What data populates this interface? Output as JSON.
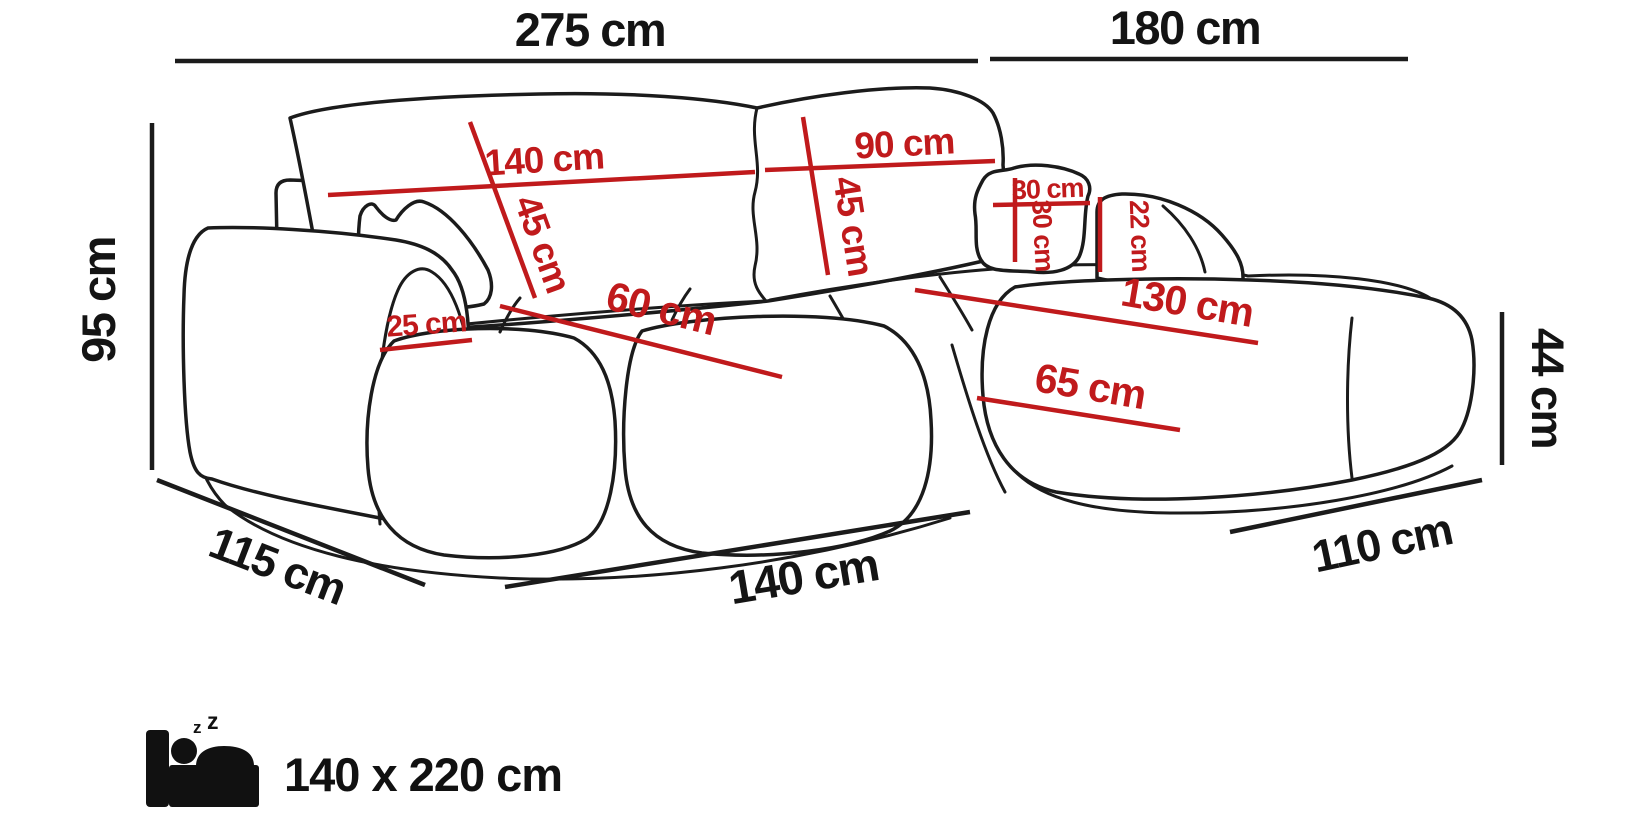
{
  "diagram": {
    "name": "corner-sofa-dimension-diagram",
    "unit": "cm",
    "accent_color": "#c01a1c",
    "line_color": "#1b1b1b",
    "background_color": "#ffffff"
  },
  "overall_dimensions": [
    {
      "id": "total-width-left-section",
      "label": "275 cm"
    },
    {
      "id": "total-width-right-section",
      "label": "180 cm"
    },
    {
      "id": "total-height",
      "label": "95 cm"
    },
    {
      "id": "depth-left-side",
      "label": "115 cm"
    },
    {
      "id": "front-width-left-section",
      "label": "140 cm"
    },
    {
      "id": "front-width-chaise",
      "label": "110 cm"
    },
    {
      "id": "seat-height",
      "label": "44 cm"
    }
  ],
  "internal_dimensions": [
    {
      "id": "backrest-left-width",
      "label": "140 cm"
    },
    {
      "id": "backrest-left-height",
      "label": "45 cm"
    },
    {
      "id": "backrest-right-width",
      "label": "90 cm"
    },
    {
      "id": "backrest-right-height",
      "label": "45 cm"
    },
    {
      "id": "pillow-width",
      "label": "30 cm"
    },
    {
      "id": "pillow-height",
      "label": "30 cm"
    },
    {
      "id": "right-armrest-height",
      "label": "22 cm"
    },
    {
      "id": "chaise-length",
      "label": "130 cm"
    },
    {
      "id": "chaise-seat-width",
      "label": "65 cm"
    },
    {
      "id": "left-armrest-width",
      "label": "25 cm"
    },
    {
      "id": "seat-depth",
      "label": "60 cm"
    }
  ],
  "sleeping_area": {
    "icon": "sleeping-bed-icon",
    "label": "140 x 220 cm",
    "z1": "z",
    "z2": "z"
  }
}
